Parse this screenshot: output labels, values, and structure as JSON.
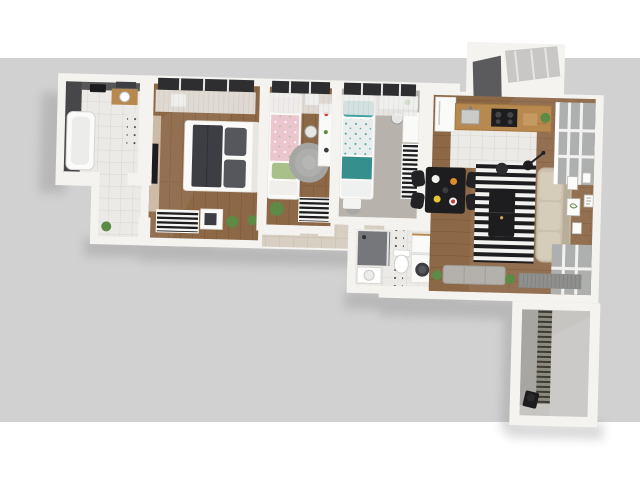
{
  "scene": {
    "type": "3d-apartment-floor-plan-render",
    "view": "top-down",
    "colors": {
      "backdrop": "#d1d1d1",
      "page": "#ffffff",
      "wall": "#f4f3f0",
      "wall_edge": "#dddbd7",
      "wood": "#8d6847",
      "wood_dark": "#7a5839",
      "tile": "#eceae7",
      "tile_line": "#d8d6d2",
      "beige_floor": "#d7cfc2",
      "beige_line": "#c7bcab",
      "gray_floor": "#b7b3ac",
      "dark_tile": "#474749",
      "ink": "#1d1d1f",
      "charcoal": "#3c3e43",
      "slate": "#55575c",
      "white_furn": "#fafaf8",
      "pink": "#ecc6cf",
      "green": "#5d8a44",
      "green_soft": "#a9c08b",
      "teal": "#3fa3a0",
      "teal_deep": "#35908d",
      "sofa": "#cbc1ae",
      "sofa_seat": "#d6ccba",
      "sofa_shade": "#b8ad97",
      "counter": "#b8894f",
      "steel": "#9c9c9a",
      "glass": "#aeb0af",
      "frame_dark": "#2e2e30",
      "radiator": "#8f8f8d",
      "concrete": "#a8a6a2",
      "balcony_floor": "#c6c5c2",
      "orange": "#e08a2e",
      "red": "#c23b2e",
      "yellow": "#e6c531"
    },
    "rooms": [
      {
        "name": "Bathroom",
        "furniture": [
          "bathtub",
          "vanity-sink",
          "mirror",
          "towel-radiator",
          "toilet",
          "dark-tile-wall",
          "dotted-tile-band"
        ]
      },
      {
        "name": "Entry Hall",
        "furniture": [
          "white-tile-floor",
          "plant"
        ]
      },
      {
        "name": "Master Bedroom",
        "furniture": [
          "double-bed",
          "dark-duvet",
          "pillows",
          "nightstand",
          "wall-tv",
          "striped-wardrobe",
          "dresser",
          "plants",
          "window-curtains"
        ]
      },
      {
        "name": "Kids Room Pink",
        "furniture": [
          "single-bed-pink-floral",
          "green-pillow",
          "round-shag-rug",
          "desk",
          "chair",
          "nightstand",
          "plant",
          "striped-sideboard"
        ]
      },
      {
        "name": "Kids Room Teal",
        "furniture": [
          "single-bed-teal",
          "floor-cushion",
          "desk",
          "chair",
          "wardrobe",
          "striped-shelf"
        ]
      },
      {
        "name": "Hallway",
        "furniture": [
          "beige-tile-floor"
        ]
      },
      {
        "name": "Second Bathroom",
        "furniture": [
          "shower",
          "toilet",
          "basin",
          "washing-machine",
          "cabinet",
          "dotted-tile-band"
        ]
      },
      {
        "name": "Kitchen",
        "furniture": [
          "fridge",
          "wood-counter",
          "sink",
          "cooktop",
          "cutting-board",
          "plant"
        ]
      },
      {
        "name": "Dining Area",
        "furniture": [
          "black-table",
          "four-chairs",
          "plates",
          "fruit-bowl"
        ]
      },
      {
        "name": "Living Room",
        "furniture": [
          "striped-rug",
          "coffee-table",
          "side-table",
          "floor-lamp",
          "beige-sofa",
          "wall-frames",
          "bench",
          "radiator",
          "plants",
          "windows"
        ]
      },
      {
        "name": "Balcony",
        "furniture": [
          "railing",
          "concrete-wall",
          "grill"
        ]
      }
    ]
  }
}
